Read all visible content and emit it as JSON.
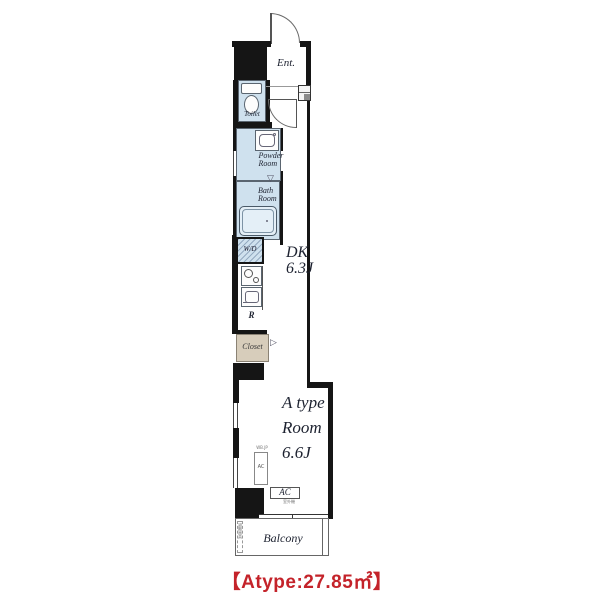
{
  "plan": {
    "labels": {
      "entrance": "Ent.",
      "toilet": "Toilet",
      "powder_room_line1": "Powder",
      "powder_room_line2": "Room",
      "bath_room_line1": "Bath",
      "bath_room_line2": "Room",
      "washer_dryer": "W/D",
      "dk_name": "DK",
      "dk_size": "6.3J",
      "fridge": "R",
      "closet": "Closet",
      "room_line1": "A type",
      "room_line2": "Room",
      "room_size": "6.6J",
      "ac_wall_unit": "AC",
      "ac_wall_note": "WB.JP",
      "ac_outdoor": "AC",
      "ac_outdoor_note": "室外機",
      "balcony": "Balcony",
      "hatch_note": "避難器具"
    },
    "caption": "【Atype:27.85㎡】",
    "colors": {
      "wet_area": "#cfe1ee",
      "closet_fill": "#d7cdbb",
      "wall": "#151515",
      "caption_red": "#c4232a"
    }
  }
}
